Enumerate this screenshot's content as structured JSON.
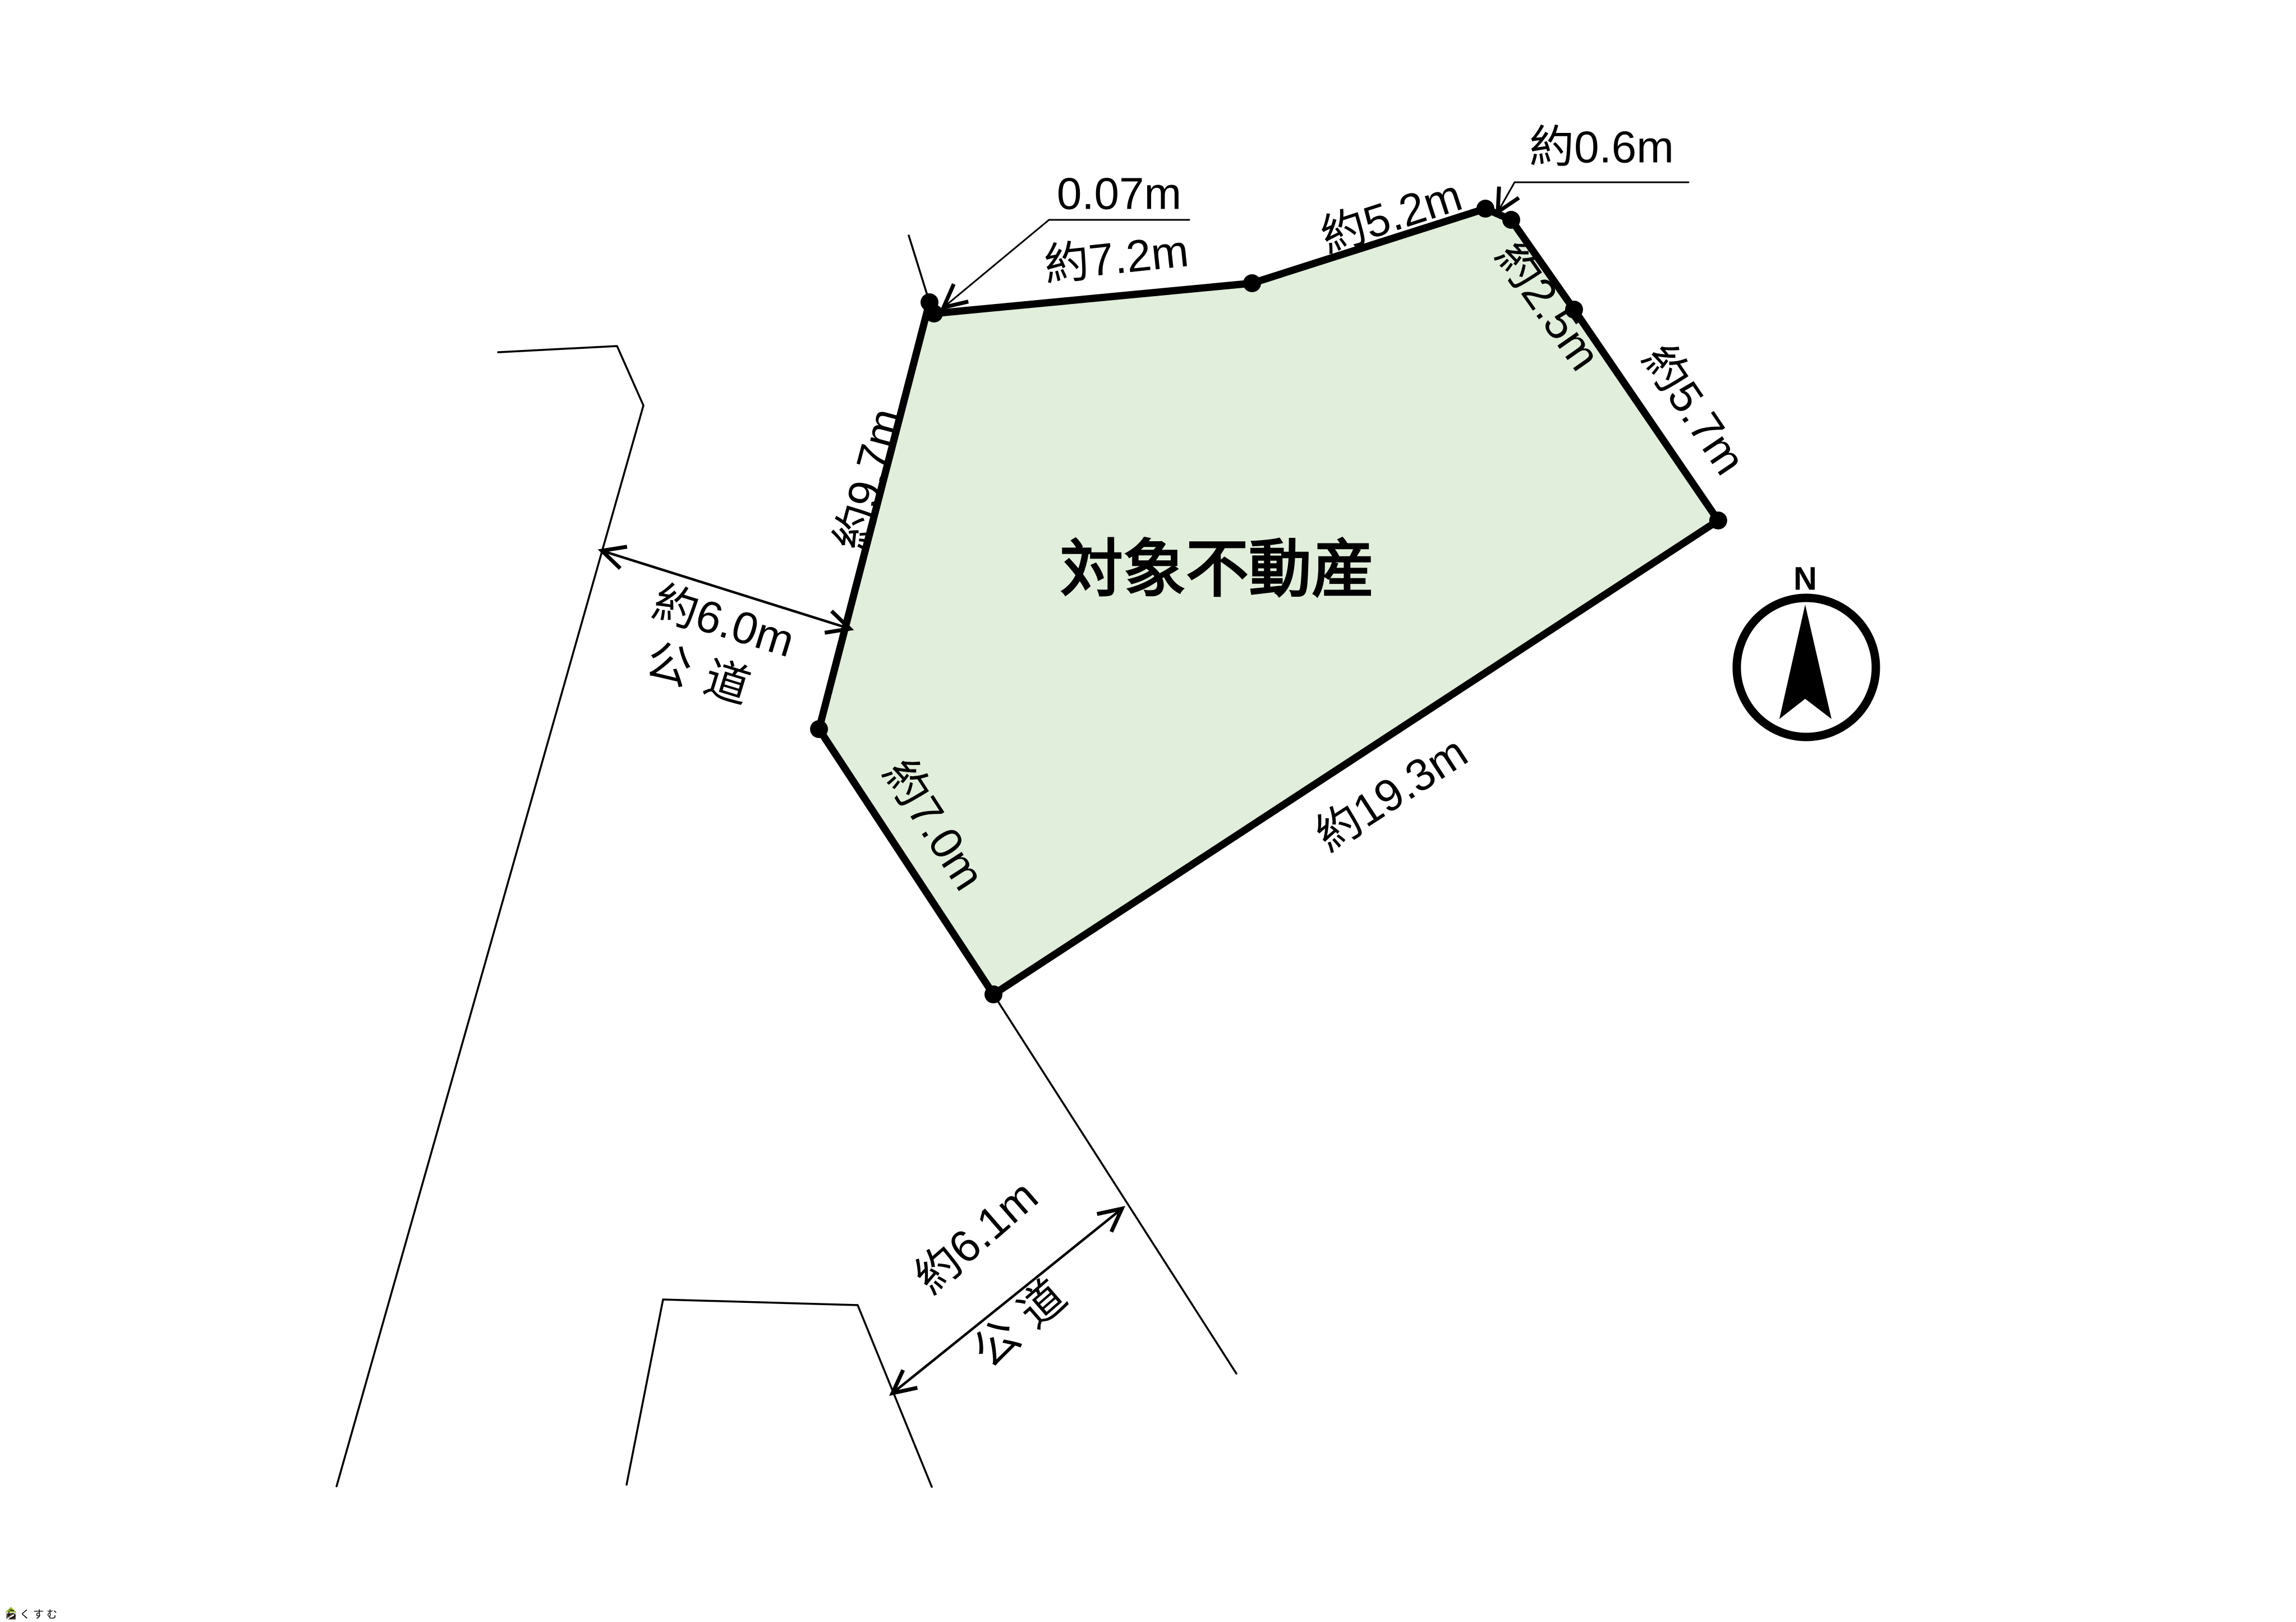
{
  "diagram": {
    "parcel_label": "対象不動産",
    "compass_label": "N",
    "dimensions": {
      "jog_nw": "0.07m",
      "edge_top_west": "約7.2m",
      "edge_top_east": "約5.2m",
      "jog_ne": "約0.6m",
      "edge_ne": "約2.5m",
      "edge_east": "約5.7m",
      "edge_west": "約9.7m",
      "edge_south": "約19.3m",
      "edge_sw": "約7.0m"
    },
    "roads": {
      "west": {
        "width": "約6.0m",
        "type": "公道"
      },
      "south": {
        "width": "約6.1m",
        "type": "公道"
      }
    },
    "watermark": "らくすむ",
    "colors": {
      "parcel_fill": "#e1eedb",
      "line": "#000000",
      "watermark_text": "#a39288",
      "watermark_roof": "#9ab636",
      "watermark_body": "#4e4238"
    }
  }
}
